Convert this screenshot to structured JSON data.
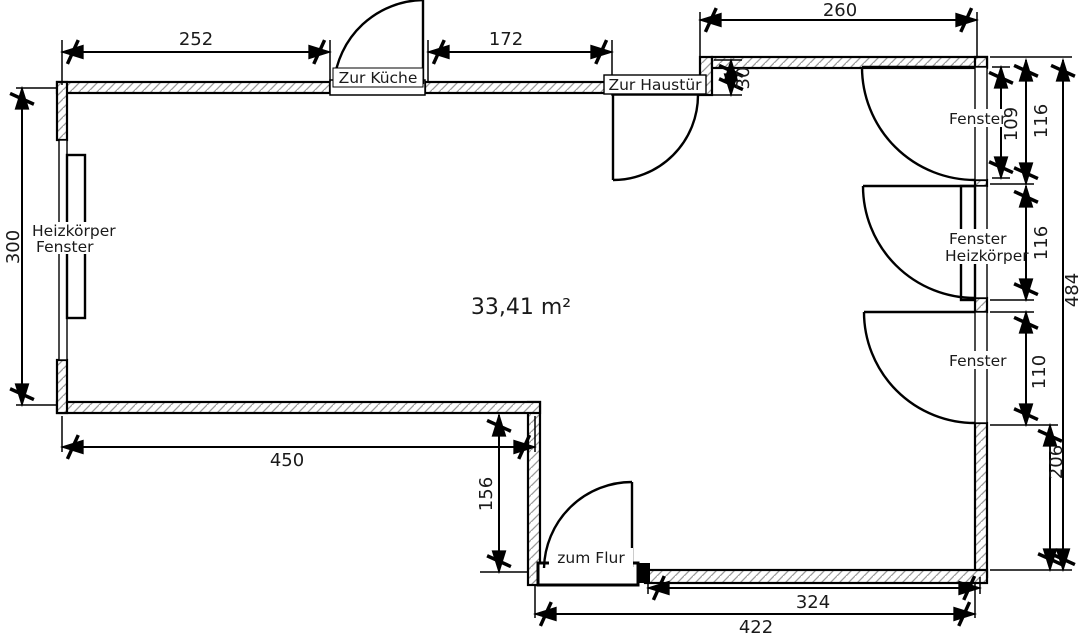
{
  "plan": {
    "area_label": "33,41 m²",
    "doors": {
      "kitchen": "Zur Küche",
      "front": "Zur Haustür",
      "hall": "zum Flur"
    },
    "windows": {
      "left": {
        "line1": "Heizkörper",
        "line2": "Fenster"
      },
      "right1": {
        "label": "Fenster"
      },
      "right2": {
        "line1": "Fenster",
        "line2": "Heizkörper"
      },
      "right3": {
        "label": "Fenster"
      }
    },
    "dims": {
      "top_left": "252",
      "top_mid": "172",
      "top_right": "260",
      "top_step": "30",
      "left": "300",
      "bottom_left": "450",
      "notch": "156",
      "win1_inner": "109",
      "win1": "116",
      "win2": "116",
      "win3": "110",
      "right_lower": "206",
      "right_total": "484",
      "bottom_right": "324",
      "bottom_total": "422"
    },
    "colors": {
      "line": "#000000",
      "hatch": "#9a9a9a",
      "background": "#ffffff"
    }
  }
}
